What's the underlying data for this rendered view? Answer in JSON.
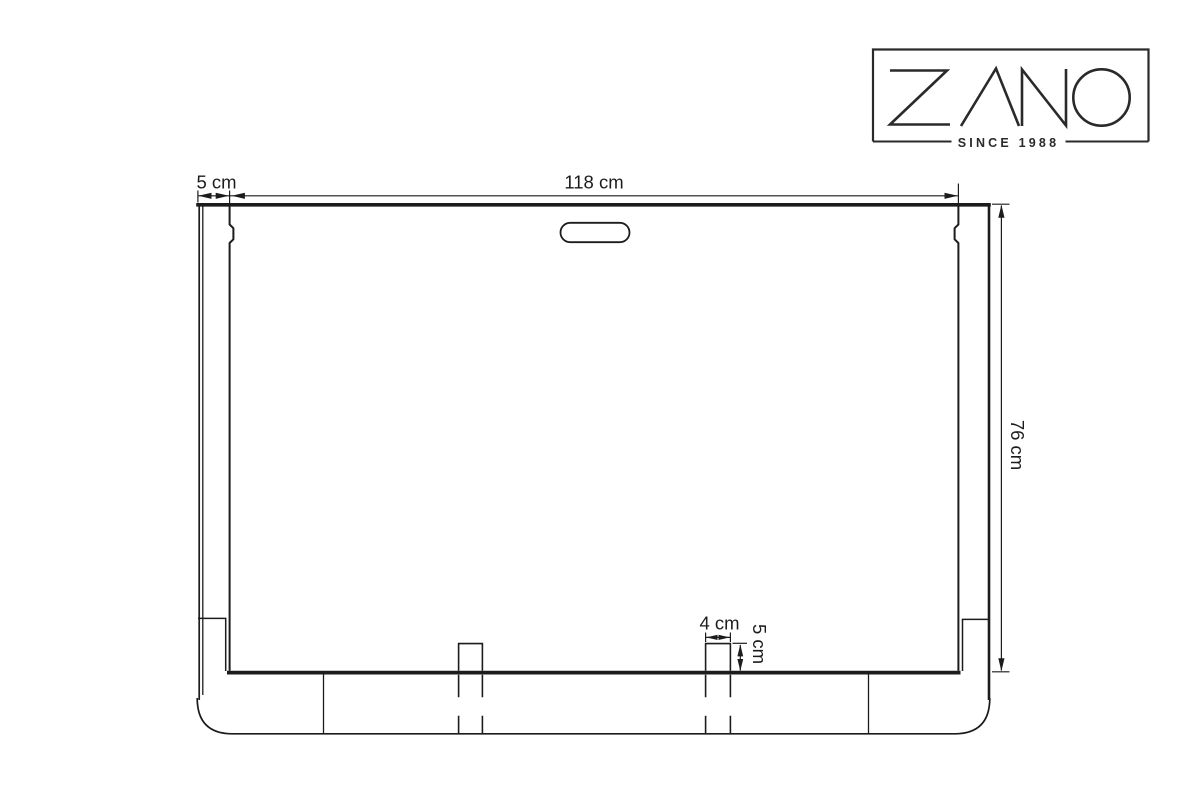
{
  "window": {
    "background": "#ffffff",
    "ink": "#1c1c1c"
  },
  "logo": {
    "brand": "ZANO",
    "tagline": "SINCE 1988",
    "color": "#2a2a2a"
  },
  "drawing": {
    "labels": {
      "side_wall": "5 cm",
      "inner_width": "118 cm",
      "height": "76 cm",
      "tab_width": "4 cm",
      "tab_height": "5 cm"
    }
  }
}
